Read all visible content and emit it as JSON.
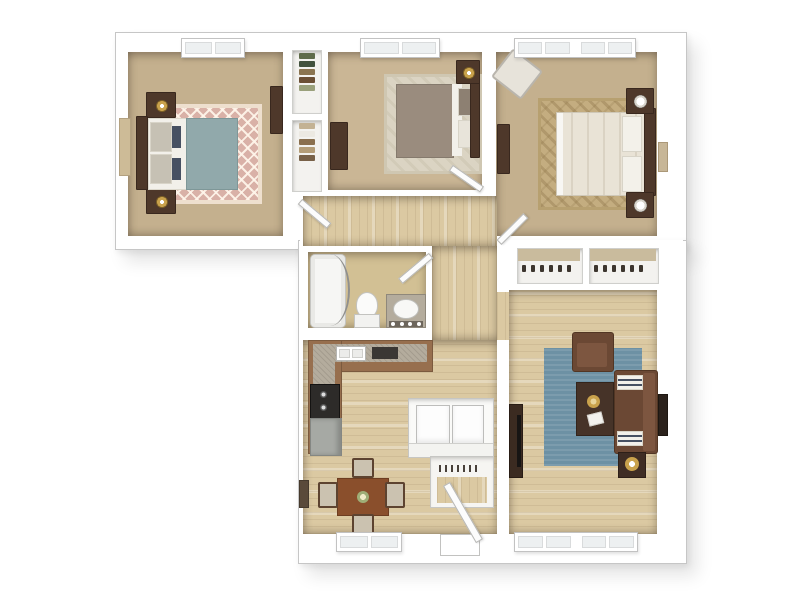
{
  "meta": {
    "type": "floor-plan",
    "view": "3d-dollhouse-top-down",
    "visible_text": "",
    "description": "Three-bedroom one-bath apartment 3D floor plan on white background, L-shaped footprint"
  },
  "palette": {
    "page_bg": "#ffffff",
    "wall": "#ffffff",
    "wall_line": "#c6c6c6",
    "carpet": "#c4b08e",
    "carpet_light": "#cab695",
    "wood": "#dbc9a2",
    "rug1_base": "#d9b1a7",
    "rug2": "#dbd4c3",
    "rug3": "#c4ad80",
    "rug_blue": "#6d91a4",
    "teal_duvet": "#91a9ab",
    "taupe_duvet": "#9a8c7e",
    "cream_duvet": "#e9e3d6",
    "linen_white": "#f2f0ea",
    "dark_wood": "#4e382a",
    "darker_wood": "#39281e",
    "sofa_brown": "#6b4834",
    "sofa_brown_light": "#7d5640",
    "cabinet_brown": "#976f4e",
    "granite": "#b4ac9d",
    "appliance_black": "#2d2b29",
    "appliance_gray": "#a6a9a4",
    "gold": "#c9a24c",
    "navy": "#465062",
    "closet_bg": "#f3f2ef",
    "shoe_dark": "#3c352e",
    "table_wood": "#8a4f2c",
    "chair_seat": "#cbc2b0"
  },
  "rooms": {
    "bedroom1": {
      "label": "Bedroom 1 (top left)",
      "floor": "carpet",
      "furniture": [
        "bed with teal duvet and headboard on left wall",
        "two dark nightstands with gold lamps",
        "pink diamond-lattice rug",
        "dresser on right wall",
        "tan wall mirror on left wall",
        "window on top wall"
      ]
    },
    "bedroom2": {
      "label": "Bedroom 2 (top middle)",
      "floor": "carpet",
      "furniture": [
        "bed with taupe duvet and headboard on right wall",
        "nightstand with gold lamp",
        "light patterned rug",
        "dresser on left wall",
        "window on top wall"
      ]
    },
    "bedroom3": {
      "label": "Master bedroom (top right)",
      "floor": "carpet",
      "furniture": [
        "bed with cream duvet and headboard on right wall",
        "two nightstands with white lamps",
        "tan damask rug",
        "cream accent chair in top-left corner",
        "dresser on left wall",
        "wide double window on top wall"
      ]
    },
    "closets_bedroom": {
      "label": "Two hall closets with hanging clothes",
      "floor": "closet-white"
    },
    "hallway": {
      "label": "Hallway",
      "floor": "wood"
    },
    "bathroom": {
      "label": "Bathroom",
      "floor": "wood",
      "furniture": [
        "bathtub with curved curtain rod",
        "toilet",
        "granite vanity with sink and four vanity lights"
      ]
    },
    "kitchen": {
      "label": "Kitchen",
      "floor": "wood",
      "furniture": [
        "L-shaped granite counter",
        "double sink",
        "dark cooktop",
        "black range",
        "gray refrigerator"
      ]
    },
    "dining": {
      "label": "Dining area",
      "floor": "wood",
      "furniture": [
        "wood dining table with flower centerpiece",
        "four chairs",
        "window on bottom wall"
      ]
    },
    "laundry": {
      "label": "Laundry closet",
      "floor": "white",
      "furniture": [
        "washer",
        "dryer",
        "front counter"
      ]
    },
    "coat_closet": {
      "label": "Entry coat closet",
      "floor": "wood",
      "furniture": [
        "hanger rod with hangers"
      ]
    },
    "living": {
      "label": "Living room",
      "floor": "wood",
      "furniture": [
        "steel-blue area rug",
        "brown armchair",
        "dark coffee table with gold tray and papers",
        "brown sofa with two striped pillows",
        "dark side table with gold tray",
        "TV console on left wall",
        "wall art on right wall",
        "wide double window on bottom wall"
      ]
    },
    "closets_living": {
      "label": "Two living-room closets with shoe shelves",
      "floor": "closet-white"
    },
    "entry": {
      "label": "Front entry door with open door leaf",
      "floor": "wood"
    }
  },
  "windows": {
    "top_wall": 3,
    "bottom_wall": 2
  },
  "doors": [
    "bedroom-1 door",
    "bedroom-2 door",
    "master-bedroom door",
    "bathroom door",
    "front entry door"
  ]
}
